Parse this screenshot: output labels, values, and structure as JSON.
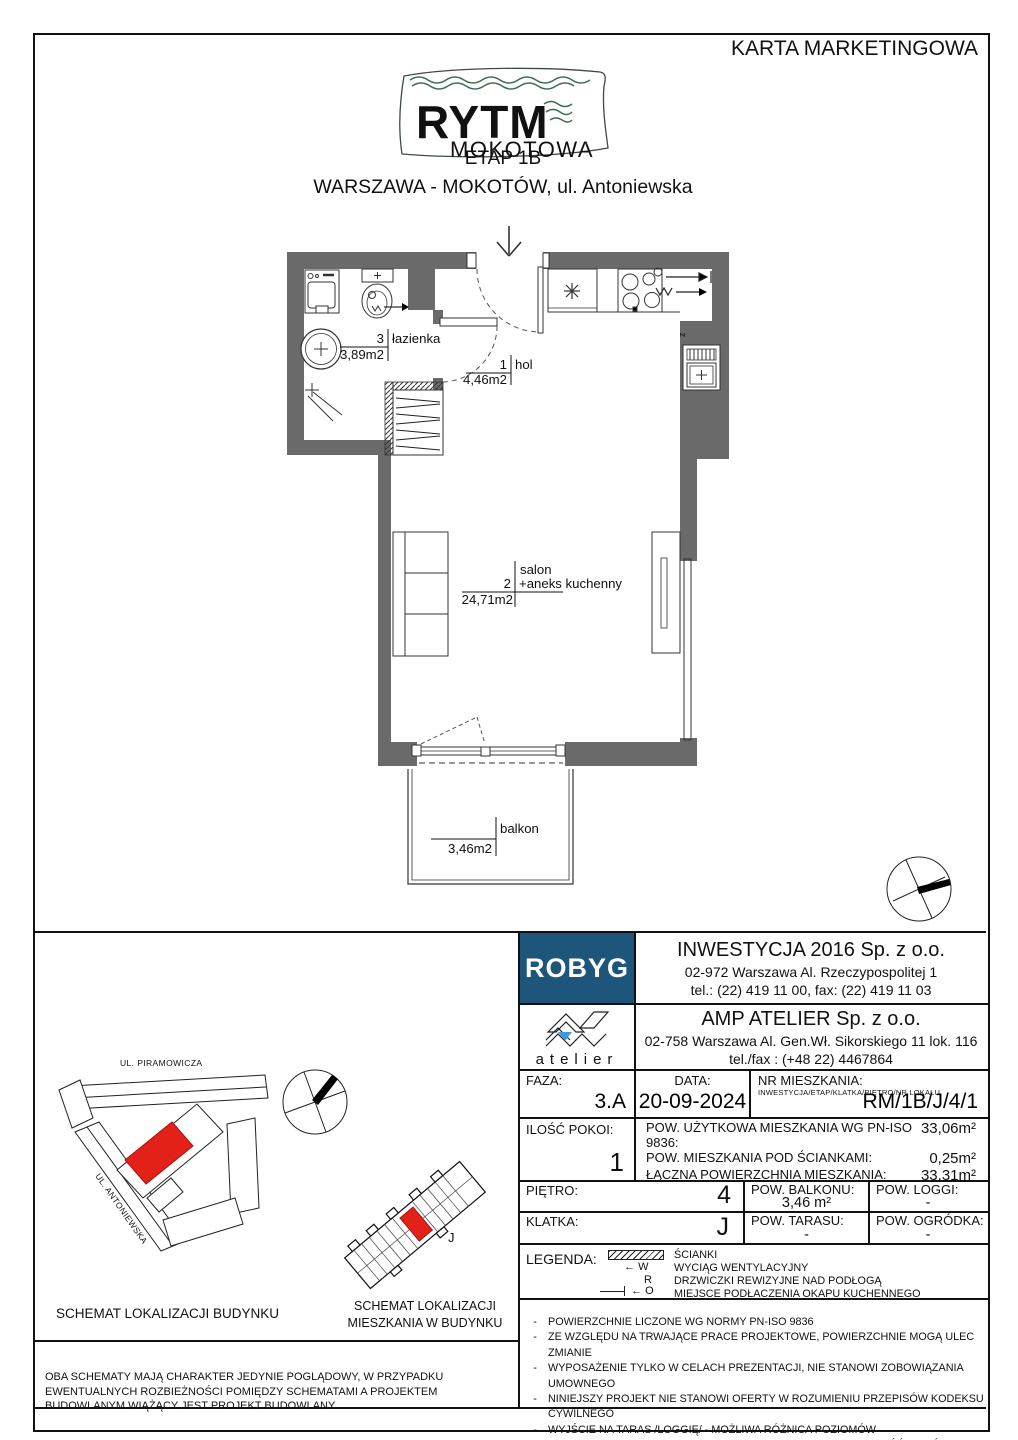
{
  "page": {
    "title": "KARTA MARKETINGOWA"
  },
  "header": {
    "logo_line1": "RYTM",
    "logo_line2": "MOKOTOWA",
    "etap": "ETAP 1B",
    "location": "WARSZAWA - MOKOTÓW, ul. Antoniewska"
  },
  "floorplan": {
    "rooms": [
      {
        "no": "3",
        "name": "łazienka",
        "area": "3,89m2"
      },
      {
        "no": "1",
        "name": "hol",
        "area": "4,46m2"
      },
      {
        "no": "2",
        "name": "salon",
        "name2": "+aneks kuchenny",
        "area": "24,71m2"
      }
    ],
    "balcony": {
      "name": "balkon",
      "area": "3,46m2"
    },
    "shaft_mark": "z"
  },
  "developer": {
    "logo": "ROBYG",
    "name": "INWESTYCJA 2016 Sp. z o.o.",
    "address": "02-972 Warszawa Al. Rzeczypospolitej 1",
    "phone": "tel.: (22) 419 11 00, fax: (22) 419 11 03"
  },
  "architect": {
    "logo": "atelier",
    "name": "AMP ATELIER Sp. z o.o.",
    "address": "02-758 Warszawa Al. Gen.Wł. Sikorskiego 11 lok. 116",
    "phone": "tel./fax : (+48 22) 4467864"
  },
  "details": {
    "faza_label": "FAZA:",
    "faza": "3.A",
    "data_label": "DATA:",
    "data": "20-09-2024",
    "nr_label": "NR MIESZKANIA:",
    "nr_sub": "INWESTYCJA/ETAP/KLATKA/PIĘTRO/NR LOKALU",
    "nr": "RM/1B/J/4/1",
    "rooms_label": "ILOŚĆ POKOI:",
    "rooms": "1",
    "areas": [
      {
        "label": "POW. UŻYTKOWA MIESZKANIA WG PN-ISO 9836:",
        "value": "33,06m²"
      },
      {
        "label": "POW. MIESZKANIA POD ŚCIANKAMI:",
        "value": "0,25m²"
      },
      {
        "label": "ŁĄCZNA POWIERZCHNIA MIESZKANIA:",
        "value": "33,31m²"
      }
    ],
    "pietro_label": "PIĘTRO:",
    "pietro": "4",
    "balkon_label": "POW. BALKONU:",
    "balkon": "3,46 m²",
    "loggia_label": "POW. LOGGI:",
    "loggia": "-",
    "klatka_label": "KLATKA:",
    "klatka": "J",
    "taras_label": "POW. TARASU:",
    "taras": "-",
    "ogrodek_label": "POW. OGRÓDKA:",
    "ogrodek": "-"
  },
  "legend": {
    "label": "LEGENDA:",
    "w_mark": "W",
    "r_mark": "R",
    "o_mark": "O",
    "items": [
      "ŚCIANKI",
      "WYCIĄG WENTYLACYJNY",
      "DRZWICZKI REWIZYJNE NAD PODŁOGĄ",
      "MIEJSCE PODŁACZENIA OKAPU KUCHENNEGO"
    ]
  },
  "notes": [
    "POWIERZCHNIE LICZONE WG NORMY PN-ISO 9836",
    "ZE WZGLĘDU NA TRWAJĄCE PRACE PROJEKTOWE, POWIERZCHNIE MOGĄ ULEC ZMIANIE",
    "WYPOSAŻENIE TYLKO W CELACH PREZENTACJI, NIE STANOWI ZOBOWIĄZANIA UMOWNEGO",
    "NINIEJSZY PROJEKT NIE STANOWI OFERTY W ROZUMIENIU PRZEPISÓW KODEKSU CYWILNEGO",
    "WYJŚCIE NA TARAS /LOGGIĘ/ - MOŻLIWA RÓŻNICA POZIOMÓW",
    "PIONY KANALIZACYJNE I PIONY WENTYLACYJNE STANOWIĄ CZĘŚĆ WSPÓLNĄ INSTALACJI BUDYNKU",
    "W PRZYPADKU WYSTĘPOWANIA OTWORU REWIZYJNEGO NA PIONIE, MUSI BYĆ ZAPEWNIONY DOSTĘP DO NIEGO, ZGODNIE Z DOKUMENTACJĄ TECHNICZNĄ"
  ],
  "schematics": {
    "street_top": "UL. PIRAMOWICZA",
    "street_left": "UL. ANTONIEWSKA",
    "caption_building": "SCHEMAT LOKALIZACJI BUDYNKU",
    "caption_flat_line1": "SCHEMAT LOKALIZACJI",
    "caption_flat_line2": "MIESZKANIA W BUDYNKU",
    "stair_letter": "J",
    "disclaimer": "OBA SCHEMATY MAJĄ CHARAKTER JEDYNIE POGLĄDOWY, W PRZYPADKU EWENTUALNYCH ROZBIEŻNOŚCI POMIĘDZY SCHEMATAMI A PROJEKTEM BUDOWLANYM WIĄŻĄCY JEST PROJEKT BUDOWLANY"
  },
  "colors": {
    "wall": "#6a6a6a",
    "robyg_blue": "#1d567a",
    "logo_green": "#3c6b52",
    "highlight_red": "#e32119",
    "atelier_blue": "#3d9ae1"
  }
}
